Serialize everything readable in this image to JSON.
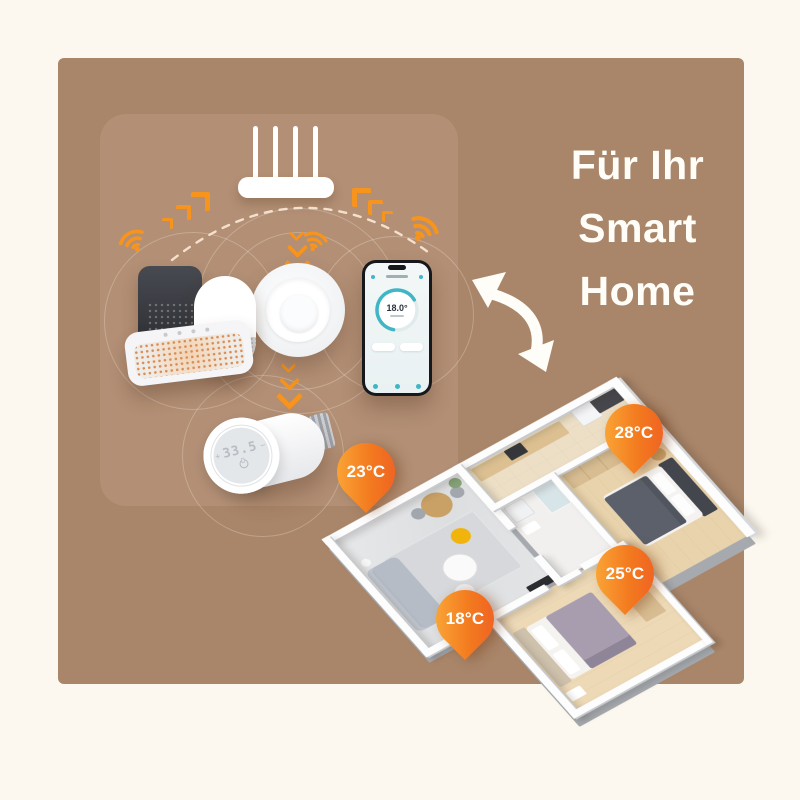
{
  "title": {
    "line1": "Für Ihr",
    "line2": "Smart",
    "line3": "Home"
  },
  "panel": {
    "phone": {
      "temperature": "18.0°"
    },
    "trv": {
      "plus": "+",
      "display": "33.5",
      "minus": "−"
    }
  },
  "floorplan": {
    "badges": [
      {
        "room": "living-room",
        "label": "23°C"
      },
      {
        "room": "entry-kitchen",
        "label": "28°C"
      },
      {
        "room": "bedroom",
        "label": "25°C"
      },
      {
        "room": "second-bedroom",
        "label": "18°C"
      }
    ]
  },
  "colors": {
    "background_cream": "#FCF8EF",
    "card_brown": "#A98569",
    "panel_brown": "#B28F75",
    "accent_orange": "#F7941D",
    "badge_gradient_start": "#FCB23D",
    "badge_gradient_end": "#EE5A24",
    "app_teal": "#3FB6C6",
    "text_white": "#FFFDF8"
  }
}
